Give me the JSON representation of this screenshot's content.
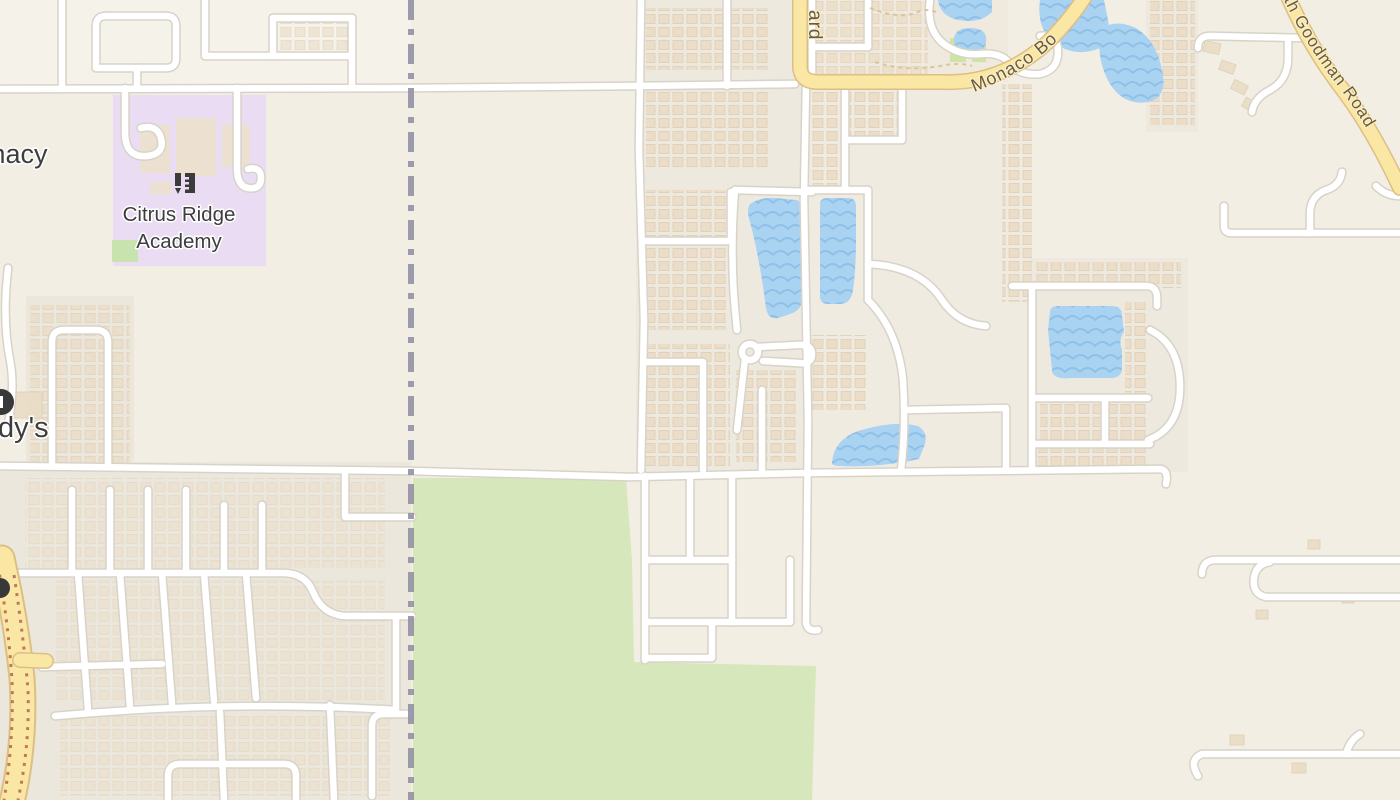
{
  "map_labels": {
    "pharmacy_fragment": "macy",
    "school_name_line1": "Citrus Ridge",
    "school_name_line2": "Academy",
    "restaurant_fragment": "dy's",
    "road_fragment_vertical": "ard",
    "road_monaco": "Monaco Bo",
    "road_goodman": "th Goodman Road"
  },
  "icons": {
    "school": "school-icon",
    "restaurant": "fast-food-icon",
    "poi_bottom_left": "poi-icon"
  },
  "colors": {
    "background": "#f2eee3",
    "residential": "#ece7dc",
    "school_area": "#eaddf3",
    "park": "#d6e8bb",
    "water": "#aad3f2",
    "water_wave": "#8fc0e8",
    "road_fill": "#ffffff",
    "road_casing": "#d8d3c9",
    "highway_fill": "#f9e7a3",
    "highway_casing": "#dcbf85",
    "boundary": "#9191a5",
    "building": "#eadcc6",
    "poi_label_color": "#3d3d3d",
    "road_label_color": "#6b5a3e"
  }
}
